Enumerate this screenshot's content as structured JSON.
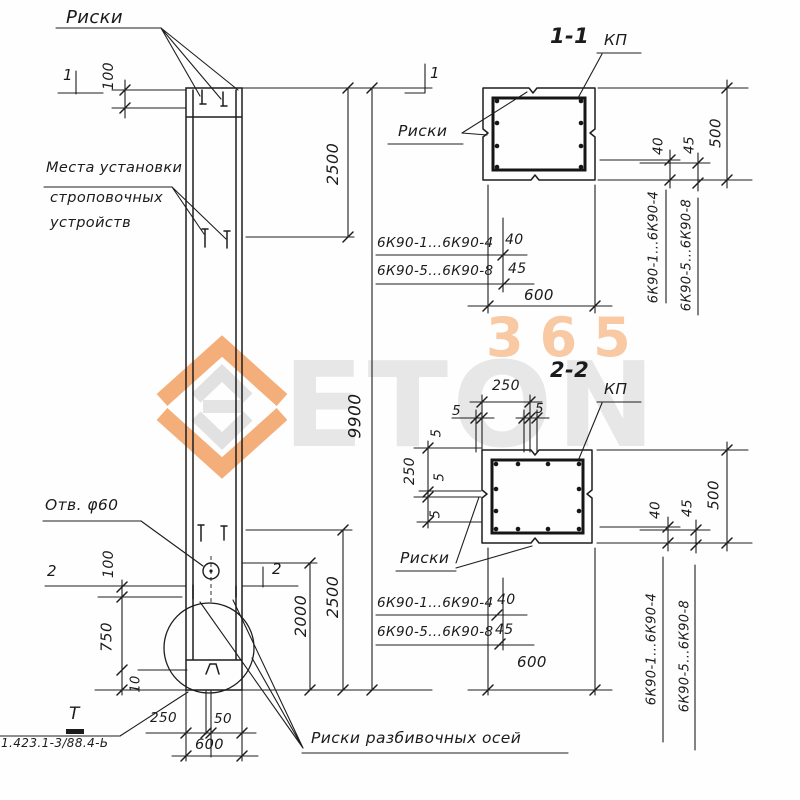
{
  "drawing": {
    "riski_label": "Риски",
    "lifting_note_line1": "Места установки",
    "lifting_note_line2": "строповочных",
    "lifting_note_line3": "устройств",
    "hole_label": "Отв. φ60",
    "axes_note": "Риски разбивочных осей",
    "series_ref": "1.423.1-3/88.4-Ь",
    "detail_mark": "Т",
    "kp_label": "КП"
  },
  "sections": {
    "s1_title": "1-1",
    "s2_title": "2-2"
  },
  "series": {
    "group_1_4": "6К90-1...6К90-4",
    "group_5_8": "6К90-5...6К90-8"
  },
  "dims": {
    "d5": "5",
    "d10": "10",
    "d40": "40",
    "d45": "45",
    "d50": "50",
    "d100": "100",
    "d250": "250",
    "d500": "500",
    "d600": "600",
    "d750": "750",
    "d2000": "2000",
    "d2500": "2500",
    "d9900": "9900"
  },
  "cuts": {
    "c1": "1",
    "c2": "2"
  },
  "watermark": {
    "brand": "ETON",
    "number": "365",
    "orange": "#f2a66c",
    "gray": "#e7e7e7",
    "peach": "#f8c9a3"
  }
}
